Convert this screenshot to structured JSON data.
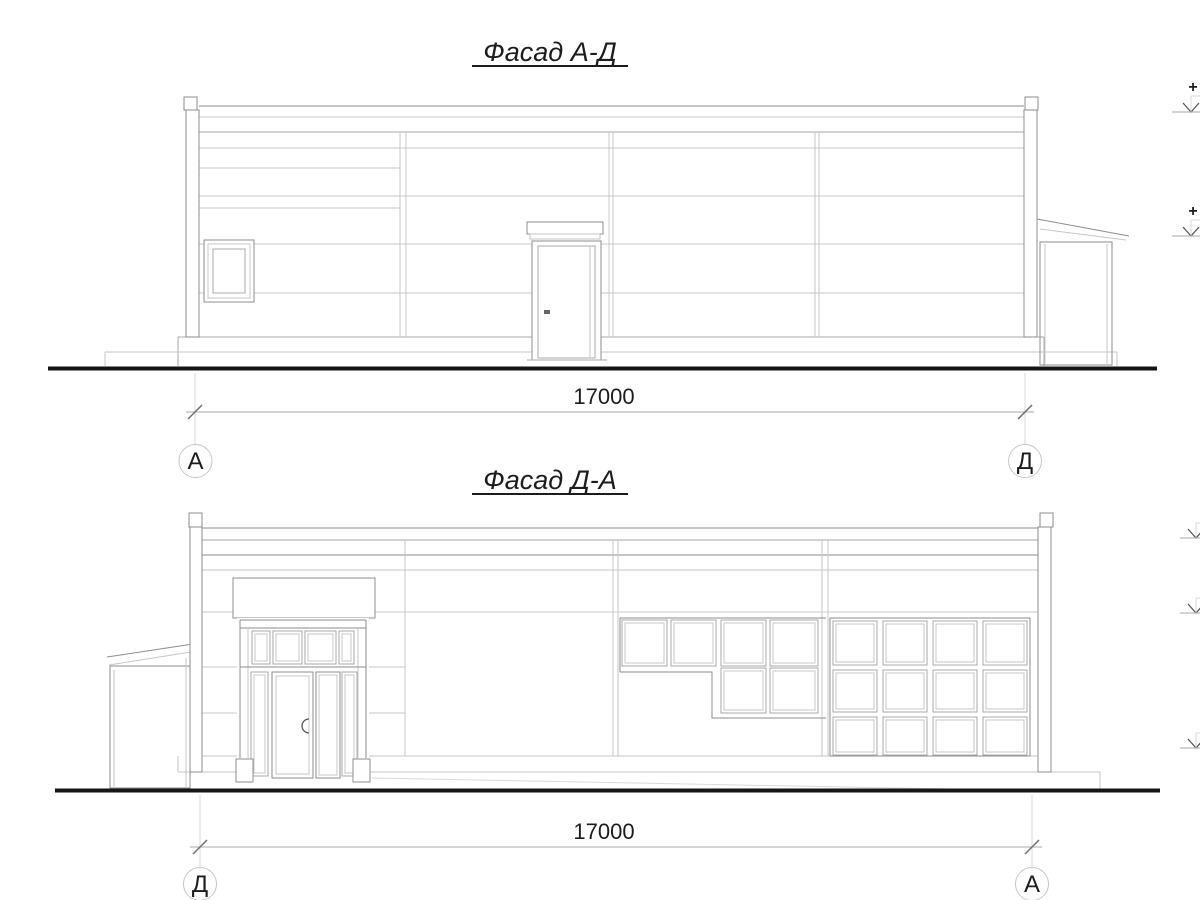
{
  "colors": {
    "background": "#ffffff",
    "ink": "#1c1c1c",
    "ground": "#161616",
    "line_strong": "#8e8e8e",
    "line_mid": "#a9a9a9",
    "line_light": "#c7c7c7"
  },
  "facade_ad": {
    "title": "Фасад А-Д",
    "dimension_label": "17000",
    "axis_left_label": "А",
    "axis_right_label": "Д",
    "elevation_upper_plus": "+",
    "elevation_lower_plus": "+"
  },
  "facade_da": {
    "title": "Фасад Д-А",
    "dimension_label": "17000",
    "axis_left_label": "Д",
    "axis_right_label": "А"
  }
}
